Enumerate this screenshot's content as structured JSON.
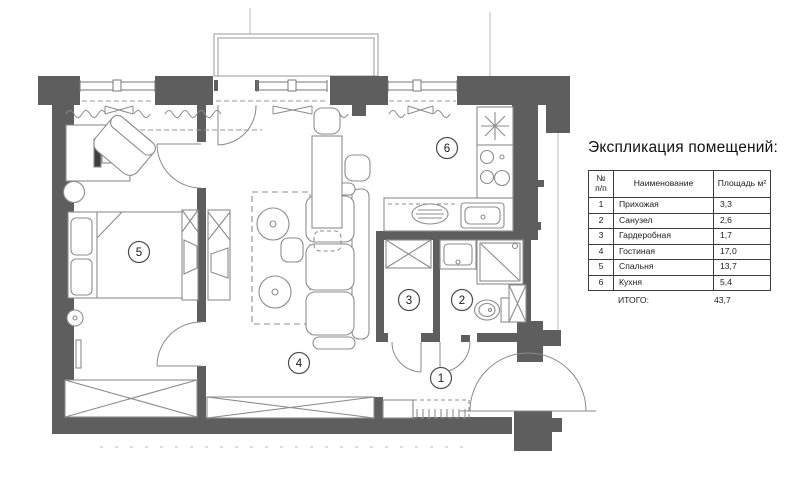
{
  "legend": {
    "title": "Экспликация помещений:",
    "table": {
      "header": {
        "num_line1": "№",
        "num_line2": "п/п",
        "name": "Наименование",
        "area": "Площадь м²"
      },
      "rows": [
        {
          "num": "1",
          "name": "Прихожая",
          "area": "3,3"
        },
        {
          "num": "2",
          "name": "Санузел",
          "area": "2,6"
        },
        {
          "num": "3",
          "name": "Гардеробная",
          "area": "1,7"
        },
        {
          "num": "4",
          "name": "Гостиная",
          "area": "17,0"
        },
        {
          "num": "5",
          "name": "Спальня",
          "area": "13,7"
        },
        {
          "num": "6",
          "name": "Кухня",
          "area": "5,4"
        }
      ],
      "total_label": "ИТОГО:",
      "total_value": "43,7"
    }
  },
  "floorplan": {
    "room_labels": [
      "1",
      "2",
      "3",
      "4",
      "5",
      "6"
    ],
    "colors": {
      "wall": "#5e5e5e",
      "structure_line": "#6e6e6e",
      "furniture_line": "#8c8c8c"
    }
  }
}
